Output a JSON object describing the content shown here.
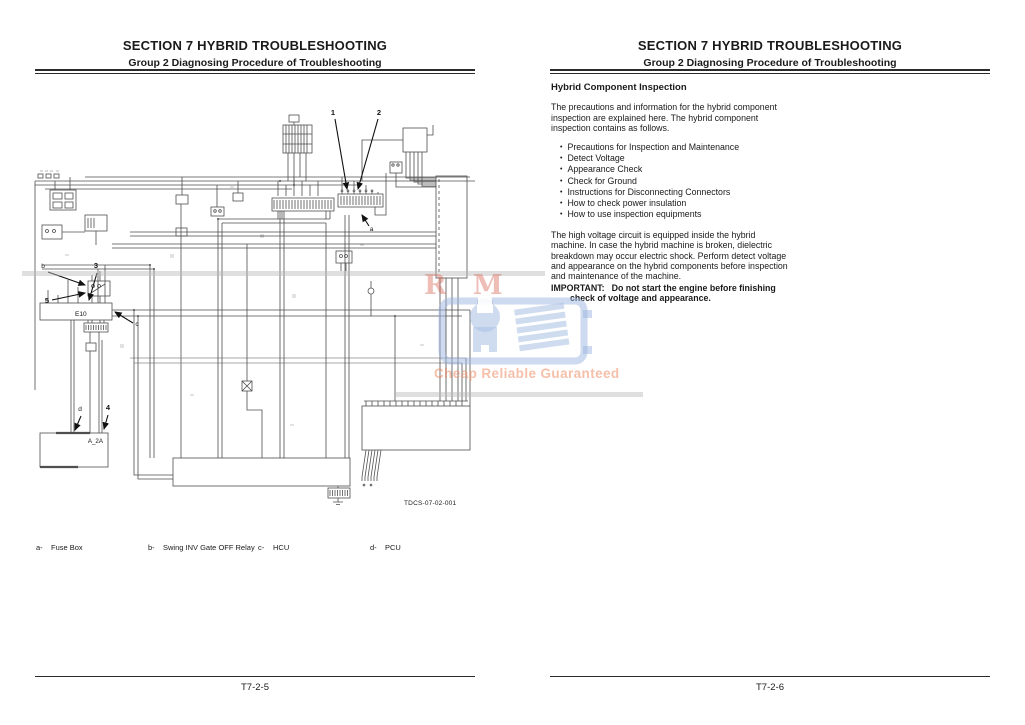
{
  "header": {
    "section": "SECTION 7 HYBRID TROUBLESHOOTING",
    "group": "Group 2 Diagnosing Procedure of Troubleshooting"
  },
  "left_page": {
    "page_number": "T7-2-5",
    "diagram": {
      "figure_code": "TDCS-07-02-001",
      "callouts": {
        "n1": "1",
        "n2": "2",
        "n3": "3",
        "n4": "4",
        "n5": "5",
        "a": "a",
        "b": "b",
        "c": "c",
        "d": "d"
      },
      "box_labels": {
        "e10": "E10",
        "a2a": "A_2A"
      },
      "legend": [
        {
          "key": "a-",
          "label": "Fuse Box"
        },
        {
          "key": "b-",
          "label": "Swing INV Gate OFF Relay"
        },
        {
          "key": "c-",
          "label": "HCU"
        },
        {
          "key": "d-",
          "label": "PCU"
        }
      ]
    }
  },
  "right_page": {
    "page_number": "T7-2-6",
    "title": "Hybrid Component Inspection",
    "intro": "The precautions and information for the hybrid component inspection are explained here. The hybrid component inspection contains as follows.",
    "bullets": [
      "Precautions for Inspection and Maintenance",
      "Detect Voltage",
      "Appearance Check",
      "Check for Ground",
      "Instructions for Disconnecting Connectors",
      "How to check power insulation",
      "How to use inspection equipments"
    ],
    "body": "The high voltage circuit is equipped inside the hybrid machine. In case the hybrid machine is broken, dielectric breakdown may occur electric shock. Perform detect voltage and appearance on the hybrid components before inspection and maintenance of the machine.",
    "important_label": "IMPORTANT:",
    "important_text": "Do not start the engine before finishing check of voltage and appearance."
  },
  "watermark": {
    "letters": "R M",
    "caption": "Cheap Reliable Guaranteed",
    "blue": "#aec6e6",
    "orange": "#ec8054"
  }
}
